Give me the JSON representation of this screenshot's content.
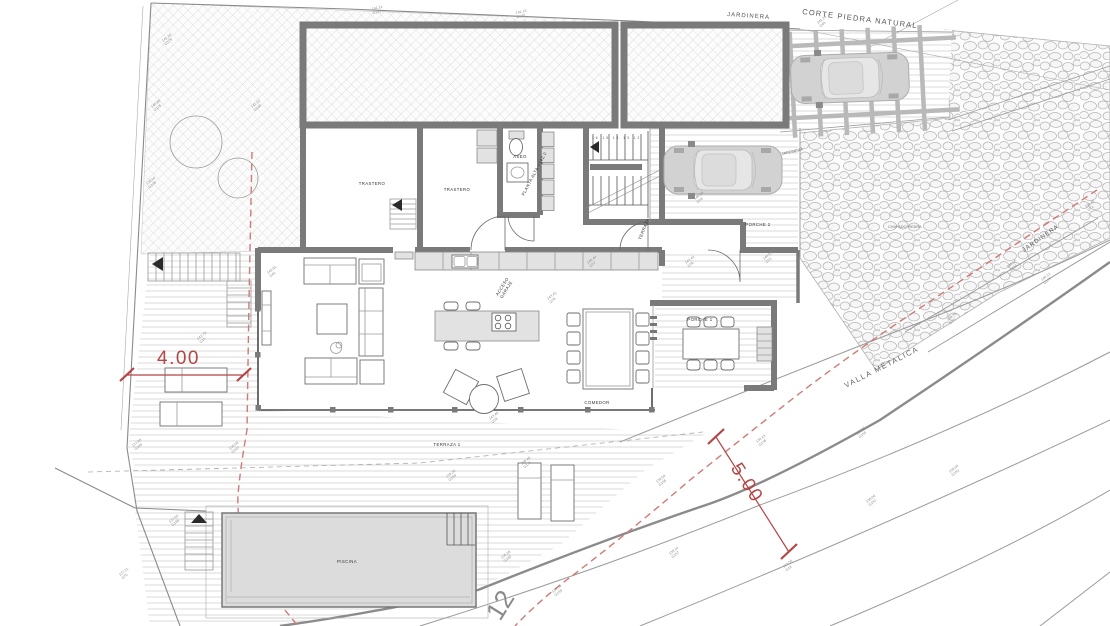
{
  "colors": {
    "dimension_red": "#b54444",
    "boundary_dash_red": "#cf7a76",
    "wall_gray": "#7a7a7a",
    "pool_fill": "#dcdcdc",
    "hatch_gray": "#c9c9c9",
    "stone_gray": "#b5b5b5"
  },
  "site": {
    "corte_piedra": "CORTE PIEDRA NATURAL",
    "jardinera_top": "JARDINERA",
    "jardinera_right": "JARDINERA",
    "jardinera_ramp": "JARDINERA",
    "chapado_piedra": "CHAPADO PIEDRA",
    "valla_metalica": "VALLA METALICA",
    "plot_number": "12"
  },
  "rooms": {
    "trastero_1": "TRASTERO",
    "trastero_2": "TRASTERO",
    "aseo": "ASEO",
    "porche_2": "PORCHE 2",
    "porche_1": "PORCHE 1",
    "comedor": "COMEDOR",
    "terraza_1": "TERRAZA 1",
    "piscina": "PISCINA",
    "acceso_line1": "ACCESO",
    "acceso_line2": "GARAJE",
    "terraza_exit": "TERRAZA",
    "nivel_planta": "PLANTA ALTA +142.0"
  },
  "dimensions": {
    "terrace_width": "4.00",
    "road_setback": "5.00"
  },
  "stairs": {
    "tread_numbers": "16 15 14 13 12"
  },
  "survey_points": [
    {
      "elev": "141.26",
      "id": "G179"
    },
    {
      "elev": "140.88",
      "id": "G178"
    },
    {
      "elev": "139.94",
      "id": "G176"
    },
    {
      "elev": "141.07",
      "id": "G148"
    },
    {
      "elev": "141.21",
      "id": "G141"
    },
    {
      "elev": "141.13",
      "id": "G140"
    },
    {
      "elev": "141.25",
      "id": "G45"
    },
    {
      "elev": "142.81",
      "id": "G41"
    },
    {
      "elev": "142.79",
      "id": "G15"
    },
    {
      "elev": "143.41",
      "id": "G35"
    },
    {
      "elev": "143.44",
      "id": "G36"
    },
    {
      "elev": "140.53",
      "id": "G33"
    },
    {
      "elev": "140.44",
      "id": "G37"
    },
    {
      "elev": "143.40",
      "id": "G38"
    },
    {
      "elev": "140.28",
      "id": "G28"
    },
    {
      "elev": "137.95",
      "id": "G165"
    },
    {
      "elev": "138.58",
      "id": "G163"
    },
    {
      "elev": "137.94",
      "id": "G168"
    },
    {
      "elev": "137.21",
      "id": "G70"
    },
    {
      "elev": "139.28",
      "id": "G169"
    },
    {
      "elev": "138.48",
      "id": "G171"
    },
    {
      "elev": "138.18",
      "id": "G160"
    },
    {
      "elev": "138.09",
      "id": "G159"
    },
    {
      "elev": "138.14",
      "id": "G157"
    },
    {
      "elev": "139.09",
      "id": "G156"
    },
    {
      "elev": "138.43",
      "id": "G136"
    },
    {
      "elev": "139.65",
      "id": "G154"
    },
    {
      "elev": "133.50",
      "id": "G16"
    },
    {
      "elev": "138.06",
      "id": "G153"
    },
    {
      "elev": "139.64",
      "id": "G152"
    },
    {
      "elev": "139.40",
      "id": "G71"
    },
    {
      "elev": "140.12",
      "id": "G175"
    },
    {
      "elev": "140.05",
      "id": "G134"
    },
    {
      "elev": "139.78",
      "id": "G73"
    }
  ]
}
